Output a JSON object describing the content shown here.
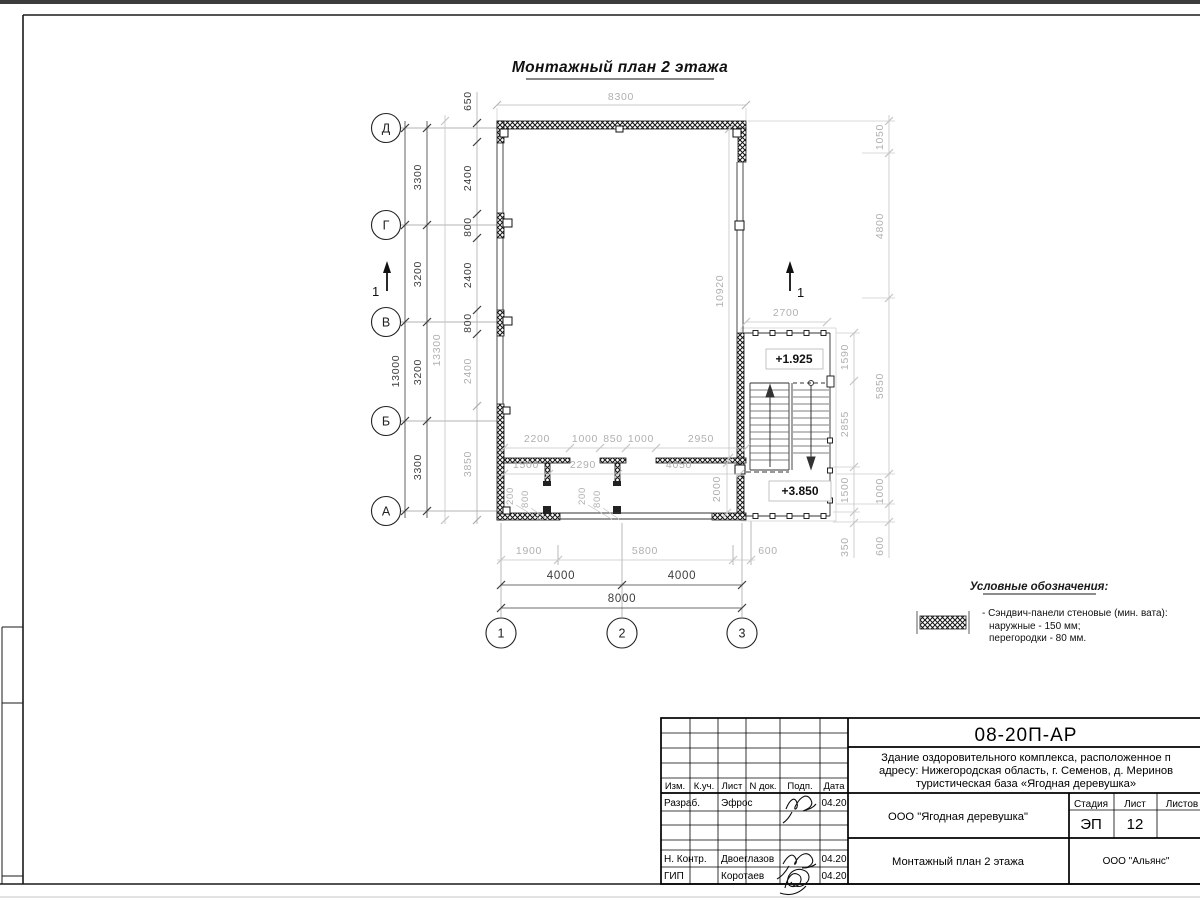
{
  "page": {
    "bg": "#ffffff",
    "frame_color": "#1a1a1a",
    "dim_gray": "#b0b0b0",
    "dim_black": "#3c3c3c",
    "top_strip_color": "#3c3c3c"
  },
  "plan": {
    "title": "Монтажный план 2 этажа",
    "row_axes": [
      "Д",
      "Г",
      "В",
      "Б",
      "А"
    ],
    "col_axes": [
      "1",
      "2",
      "3"
    ],
    "section_label": "1",
    "elev_upper": "+1.925",
    "elev_lower": "+3.850",
    "dims": {
      "top_width": "8300",
      "left_overhang": "650",
      "left_total": "13000",
      "left_ref_total": "13300",
      "left_segments": [
        "3300",
        "3200",
        "3200",
        "3300"
      ],
      "left_inner": [
        "2400",
        "800",
        "2400",
        "800",
        "2400",
        "3850"
      ],
      "hall_height": "10920",
      "room_depth": "2000",
      "interior_top": [
        "2200",
        "1000",
        "850",
        "1000",
        "2950"
      ],
      "interior_bottom": [
        "1500",
        "2290",
        "4050"
      ],
      "door_left": [
        "200",
        "800"
      ],
      "door_right": [
        "200",
        "800"
      ],
      "bottom_ref": [
        "1900",
        "5800",
        "600"
      ],
      "bottom_spans": [
        "4000",
        "4000"
      ],
      "bottom_total": "8000",
      "stair_width": "2700",
      "stair_right_inner": [
        "1590",
        "2855",
        "1500",
        "350"
      ],
      "right_outer": [
        "1050",
        "4800",
        "5850",
        "1000",
        "600"
      ]
    }
  },
  "legend": {
    "title": "Условные обозначения:",
    "item_lines": [
      "- Сэндвич-панели стеновые (мин. вата):",
      "наружные - 150 мм;",
      "перегородки - 80 мм."
    ]
  },
  "titleblock": {
    "doc_number": "08-20П-АР",
    "project_lines": [
      "Здание оздоровительного комплекса, расположенное п",
      "адресу: Нижегородская область, г. Семенов, д. Меринов",
      "туристическая база «Ягодная деревушка»"
    ],
    "client": "ООО \"Ягодная деревушка\"",
    "drawing_title": "Монтажный план 2 этажа",
    "company": "ООО \"Альянс\"",
    "stage_label": "Стадия",
    "sheet_label": "Лист",
    "sheets_label": "Листов",
    "stage": "ЭП",
    "sheet_number": "12",
    "header_cols": [
      "Изм.",
      "К.уч.",
      "Лист",
      "N док.",
      "Подп.",
      "Дата"
    ],
    "rows": [
      {
        "role": "Разраб.",
        "name": "Эфрос",
        "date": "04.20"
      },
      {
        "role": "Н. Контр.",
        "name": "Двоеглазов",
        "date": "04.20"
      },
      {
        "role": "ГИП",
        "name": "Коротаев",
        "date": "04.20"
      }
    ]
  }
}
